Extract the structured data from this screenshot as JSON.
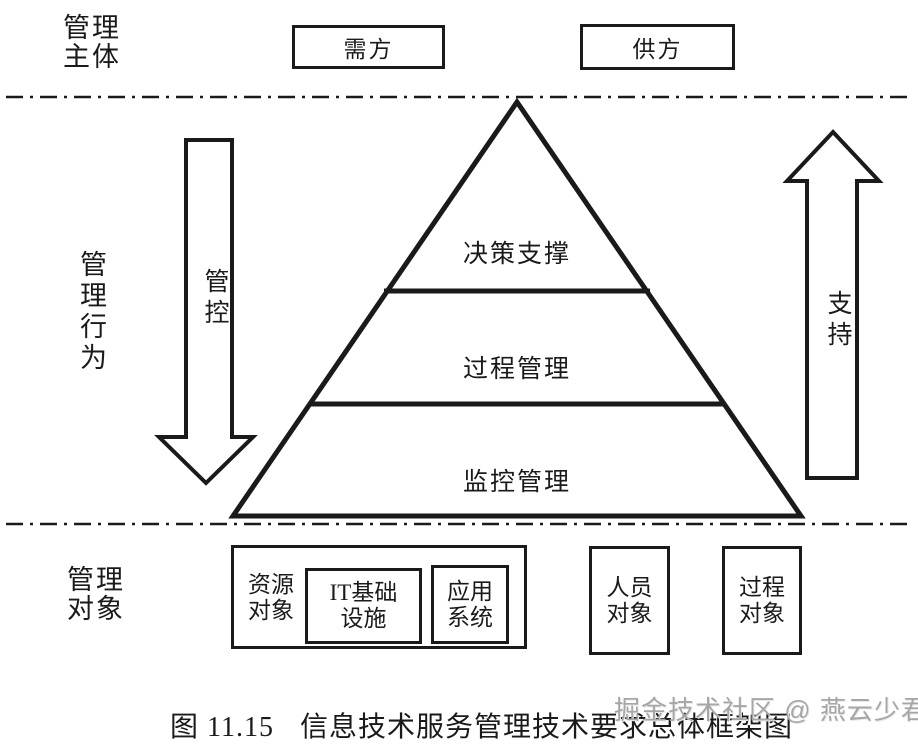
{
  "colors": {
    "ink": "#1a1a1a",
    "background": "#ffffff",
    "watermark_gray": "#a6a6a6"
  },
  "row_labels": {
    "subject_lines": [
      "管理",
      "主体"
    ],
    "behavior": "管理行为",
    "object_lines": [
      "管理",
      "对象"
    ]
  },
  "subject_boxes": {
    "demand": "需方",
    "supply": "供方"
  },
  "arrows": {
    "down_label": "管控",
    "up_label": "支持"
  },
  "pyramid": {
    "tiers": [
      {
        "label": "决策支撑"
      },
      {
        "label": "过程管理"
      },
      {
        "label": "监控管理"
      }
    ]
  },
  "object_boxes": {
    "resource_lines": [
      "资源",
      "对象"
    ],
    "it_infra_lines": [
      "IT基础",
      "设施"
    ],
    "app_system_lines": [
      "应用",
      "系统"
    ],
    "personnel_lines": [
      "人员",
      "对象"
    ],
    "process_lines": [
      "过程",
      "对象"
    ]
  },
  "caption": {
    "figure_no": "图 11.15",
    "title": "信息技术服务管理技术要求总体框架图"
  },
  "watermark": "掘金技术社区 @ 燕云少君"
}
